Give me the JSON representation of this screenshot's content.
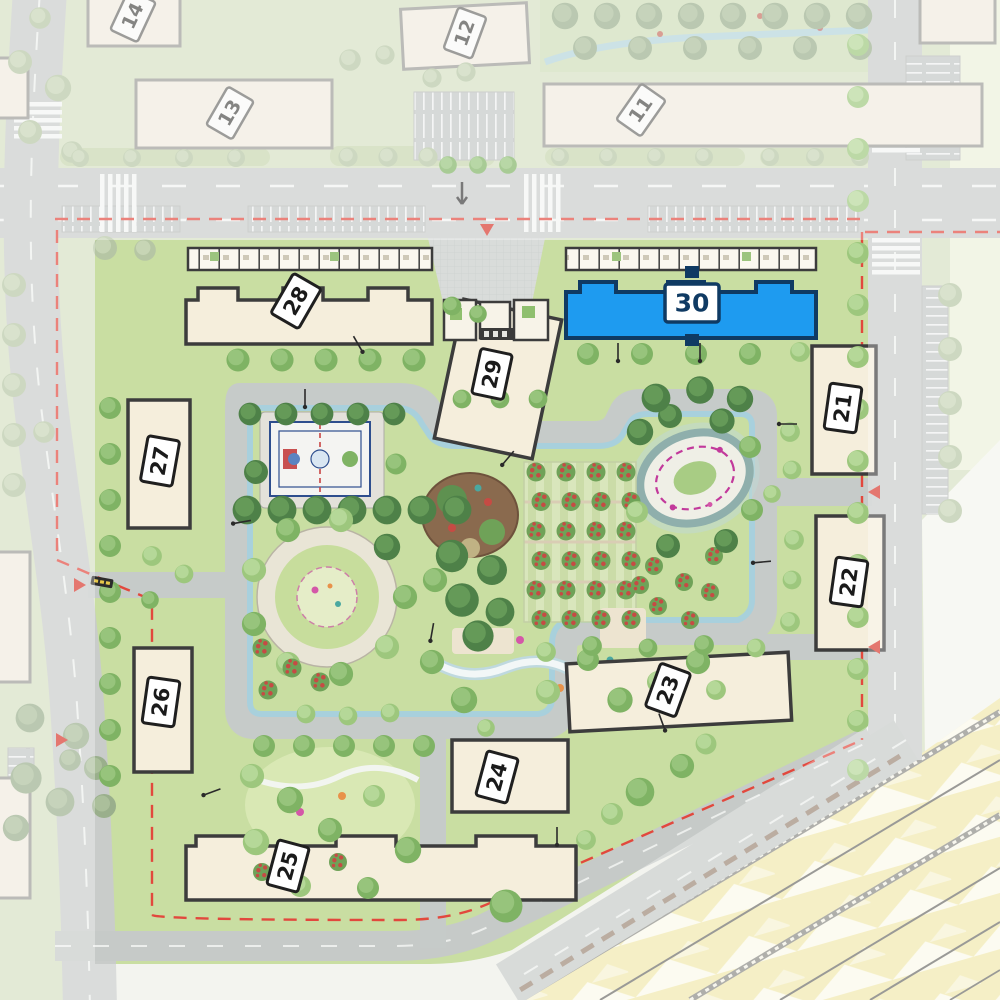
{
  "site_plan": {
    "selected_building": "30",
    "buildings": [
      {
        "id": "b21",
        "label": "21"
      },
      {
        "id": "b22",
        "label": "22"
      },
      {
        "id": "b23",
        "label": "23"
      },
      {
        "id": "b24",
        "label": "24"
      },
      {
        "id": "b25",
        "label": "25"
      },
      {
        "id": "b26",
        "label": "26"
      },
      {
        "id": "b27",
        "label": "27"
      },
      {
        "id": "b28",
        "label": "28"
      },
      {
        "id": "b29",
        "label": "29"
      },
      {
        "id": "b30",
        "label": "30"
      }
    ],
    "context_buildings": [
      {
        "id": "b14",
        "label": "14"
      },
      {
        "id": "b13",
        "label": "13"
      },
      {
        "id": "b12",
        "label": "12"
      },
      {
        "id": "b11",
        "label": "11"
      }
    ],
    "colors": {
      "selected_fill": "#1E9BF0",
      "selected_stroke": "#0F3A63",
      "building_fill": "#F5EEDC",
      "building_stroke": "#3C3C3C",
      "road": "#C9CCCA",
      "lawn": "#C9DEA2",
      "water": "#A6D0DE",
      "railway": "#F0E8AB",
      "boundary_dash": "#E2483D"
    }
  }
}
